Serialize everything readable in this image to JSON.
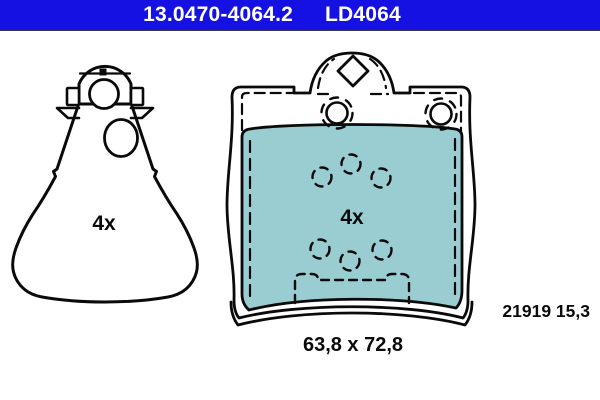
{
  "header": {
    "part_number": "13.0470-4064.2",
    "trade_number": "LD4064",
    "background_color": "#1511e3",
    "text_color": "#ffffff"
  },
  "drawings": {
    "accessory": {
      "quantity_label": "4x"
    },
    "brake_pad": {
      "quantity_label": "4x",
      "dimensions": "63,8 x 72,8",
      "spec": "21919 15,3",
      "friction_material_color": "#9acdd2",
      "line_color": "#0a0a0a"
    }
  }
}
